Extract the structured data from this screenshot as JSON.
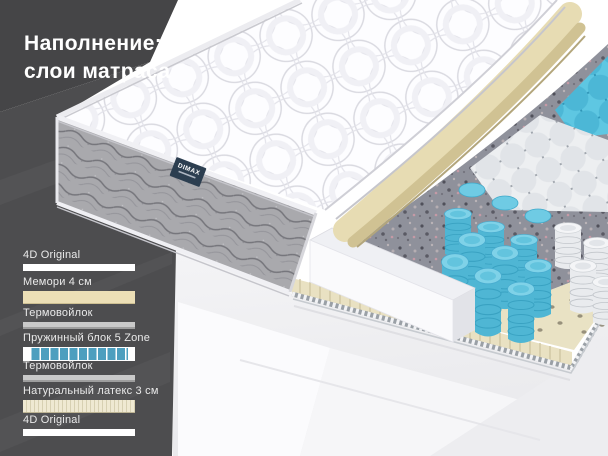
{
  "header": {
    "title_line1": "Наполнение:",
    "title_line2": "слои матраса"
  },
  "mattress": {
    "brand_tag": "DIMAX"
  },
  "legend": {
    "layers": [
      {
        "label": "4D Original",
        "type": "fabric-white"
      },
      {
        "label": "Мемори 4 см",
        "type": "foam-beige"
      },
      {
        "label": "Термовойлок",
        "type": "felt-gray"
      },
      {
        "label": "Пружинный блок 5 Zone",
        "type": "springs-blue"
      },
      {
        "label": "Термовойлок",
        "type": "felt-gray"
      },
      {
        "label": "Натуральный латекс 3 см",
        "type": "latex-striped"
      },
      {
        "label": "4D Original",
        "type": "fabric-white"
      }
    ]
  },
  "colors": {
    "panel_dark": "#454547",
    "panel_dark_lower": "#4d4d4f",
    "accent_blue": "#4d9fbf",
    "spring_blue": "#5ec7e2",
    "foam_beige": "#ecdfb6",
    "latex_cream": "#efe9d2",
    "felt_gray": "#8f919b",
    "tag_navy": "#2c3e50"
  }
}
